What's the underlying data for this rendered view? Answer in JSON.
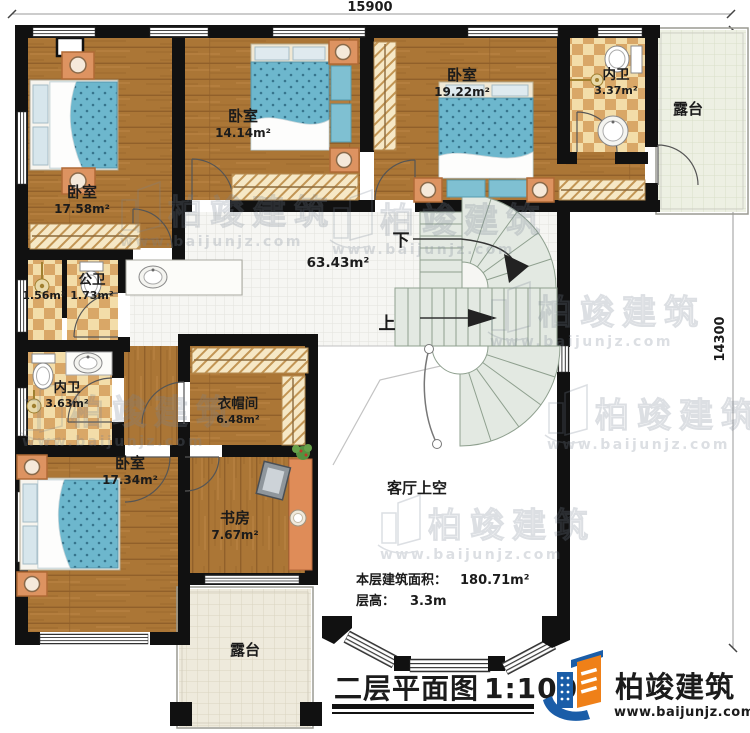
{
  "dimensions": {
    "top": "15900",
    "right": "14300"
  },
  "rooms": {
    "bedroom_tl": {
      "name": "卧室",
      "area": "17.58m²"
    },
    "bedroom_tm": {
      "name": "卧室",
      "area": "14.14m²"
    },
    "bedroom_tr": {
      "name": "卧室",
      "area": "19.22m²"
    },
    "ensuite_tr": {
      "name": "内卫",
      "area": "3.37m²"
    },
    "terrace_tr": {
      "name": "露台"
    },
    "hall": {
      "area": "63.43m²"
    },
    "shower_room": {
      "area": "1.56m²"
    },
    "public_bath": {
      "name": "公卫",
      "area": "1.73m²"
    },
    "ensuite_left": {
      "name": "内卫",
      "area": "3.63m²"
    },
    "cloakroom": {
      "name": "衣帽间",
      "area": "6.48m²"
    },
    "bedroom_bl": {
      "name": "卧室",
      "area": "17.34m²"
    },
    "study": {
      "name": "书房",
      "area": "7.67m²"
    },
    "living_void": {
      "name": "客厅上空"
    },
    "terrace_bottom": {
      "name": "露台"
    }
  },
  "stairs": {
    "down_label": "下",
    "up_label": "上"
  },
  "notes": {
    "area_label": "本层建筑面积：",
    "area_value": "180.71m²",
    "height_label": "层高：",
    "height_value": "3.3m"
  },
  "title": {
    "text": "二层平面图",
    "scale": "1:100"
  },
  "brand": {
    "name": "柏竣建筑",
    "url": "www.baijunjz.com"
  },
  "watermark": {
    "name": "柏竣建筑",
    "url": "www.baijunjz.com"
  },
  "colors": {
    "wall": "#111111",
    "wood": "#ab7636",
    "checker_tile": "#d9a767",
    "hall_tile": "#f6f6f3",
    "terrace_tile": "#eeeadc",
    "mattress": "#6db7cd",
    "stair": "#e3e9e2",
    "furniture_orange": "#dd9361",
    "br_blue": "#1a5da8",
    "br_orange": "#ef8018"
  }
}
